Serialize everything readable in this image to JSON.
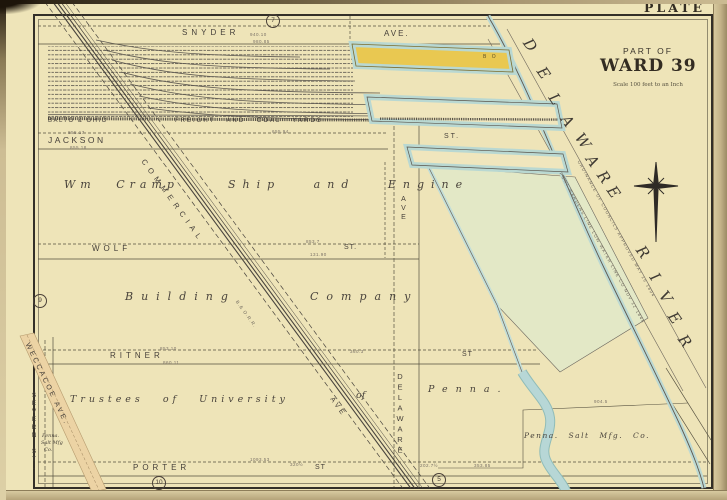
{
  "page": {
    "plate": "PLATE 8",
    "part_of": "PART OF",
    "ward": "WARD 39",
    "scale": "Scale 100 feet to an Inch"
  },
  "river": {
    "name": "DELAWARE RIVER",
    "letters1": [
      "D",
      "E",
      "L",
      "A",
      "W",
      "A",
      "R",
      "E"
    ],
    "letters2": [
      "R",
      "I",
      "V",
      "E",
      "R"
    ]
  },
  "streets": {
    "snyder": "SNYDER",
    "snyder_ave": "AVE.",
    "jackson": "JACKSON",
    "wolf": "WOLF",
    "wolf_st": "ST.",
    "ritner": "RITNER",
    "ritner_st": "ST",
    "porter": "PORTER",
    "porter_st": "ST",
    "pier_st": "ST.",
    "commercial": "COMMERCIAL",
    "commercial_ave": "AVE",
    "delaware_ave_top": "AVE",
    "delaware_ave_bottom": "DELAWARE",
    "severn": "SEVERN ST.",
    "weccacoe": "WECCACOE AVE."
  },
  "labels": {
    "yards_left": "BALTO & OHIO",
    "yards_right": "FREIGHT AND COAL YARDS",
    "cramp_a": "Wm Cramp",
    "cramp_b": "Ship and Engine",
    "cramp_c": "Building",
    "cramp_d": "Company",
    "trustees_a": "Trustees of University",
    "trustees_b": "of",
    "trustees_c": "Penna.",
    "salt_right": "Penna. Salt Mfg. Co.",
    "salt_left_1": "Penna.",
    "salt_left_2": "Salt Mfg",
    "salt_left_3": "Co.",
    "pier_building": "B O",
    "railroad": "B.& O.R.R.",
    "warden_a": "ORDINANCE OF COUNCILS APPROVED MAY 16 1894",
    "warden_b": "PORT WARDENS LINE LOW WATER LINE CO NOV 12 1846"
  },
  "plate_refs": {
    "top": "7",
    "left": "9",
    "bottom_left": "10",
    "bottom_right": "5"
  },
  "dims": [
    "940.10",
    "980.85",
    "855.17",
    "855.18",
    "655.94",
    "853.7",
    "131.90",
    "853.10",
    "860.11",
    "360.3",
    "1093.53",
    "320½",
    "202.7½",
    "353.85",
    "904.5"
  ],
  "colors": {
    "paper": "#eee4b8",
    "ink": "#46403a",
    "water_edge": "#b9d8d2",
    "pier_yellow": "#e9c851",
    "tidal_flats": "#e3e8c6",
    "weccacoe_tint": "#ecd3a4"
  }
}
